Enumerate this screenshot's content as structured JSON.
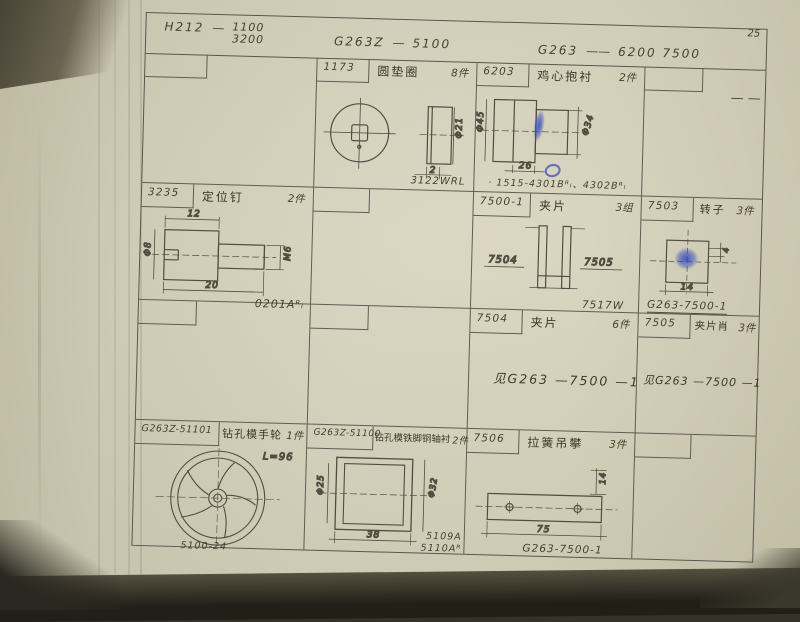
{
  "page_number": "25",
  "header": {
    "g1_model": "H212",
    "g1_dash": "—",
    "g1_num": "1100",
    "g1_den": "3200",
    "g2_model": "G263Z",
    "g2_dash": "—",
    "g2_val": "5100",
    "g3_model": "G263",
    "g3_dash": "——",
    "g3_val": "6200  7500"
  },
  "row1": {
    "washer": {
      "part_no": "1173",
      "title": "圆垫圈",
      "qty": "8件",
      "dia": "Φ21",
      "thk": "2",
      "code": "3122WRL"
    },
    "bush": {
      "part_no": "6203",
      "title": "鸡心抱衬",
      "qty": "2件",
      "dia_left": "Φ45",
      "dia_right": "Φ34",
      "len": "26",
      "code": "· 1515-4301Bᴿₗ、4302Bᴿₗ"
    },
    "right_dash": "— —"
  },
  "row2": {
    "pin": {
      "part_no": "3235",
      "title": "定位钉",
      "qty": "2件",
      "dim_top": "12",
      "dim_len": "20",
      "dia": "Φ8",
      "thread": "M6",
      "code": "0201Aᴿₗ"
    },
    "clip": {
      "part_no": "7500-1",
      "title": "夹片",
      "qty": "3组",
      "label_left": "7504",
      "label_right": "7505",
      "code": "7517W"
    },
    "rotor": {
      "part_no": "7503",
      "title": "转子",
      "qty": "3件",
      "dim": "14",
      "dim_small": "4",
      "code": "G263-7500-1"
    }
  },
  "row3": {
    "clip_piece": {
      "part_no": "7504",
      "title": "夹片",
      "qty": "6件",
      "ref": "见G263 —7500 —1"
    },
    "clip_pin": {
      "part_no": "7505",
      "title": "夹片肖",
      "qty": "3件",
      "ref": "见G263 —7500 —1"
    }
  },
  "row4": {
    "wheel": {
      "part_no": "G263Z-51101",
      "title": "钻孔模手轮",
      "qty": "1件",
      "note": "L=96",
      "code": "5100-24"
    },
    "bushing": {
      "part_no": "G263Z-51100",
      "title": "钻孔模铁脚铜轴衬",
      "qty": "2件",
      "dia_left": "Φ25",
      "dia_right": "Φ32",
      "len": "38",
      "code1": "5109A",
      "code2": "5110Aᴿ"
    },
    "hanger": {
      "part_no": "7506",
      "title": "拉簧吊攀",
      "qty": "3件",
      "len": "75",
      "height": "14",
      "code": "G263-7500-1"
    }
  }
}
